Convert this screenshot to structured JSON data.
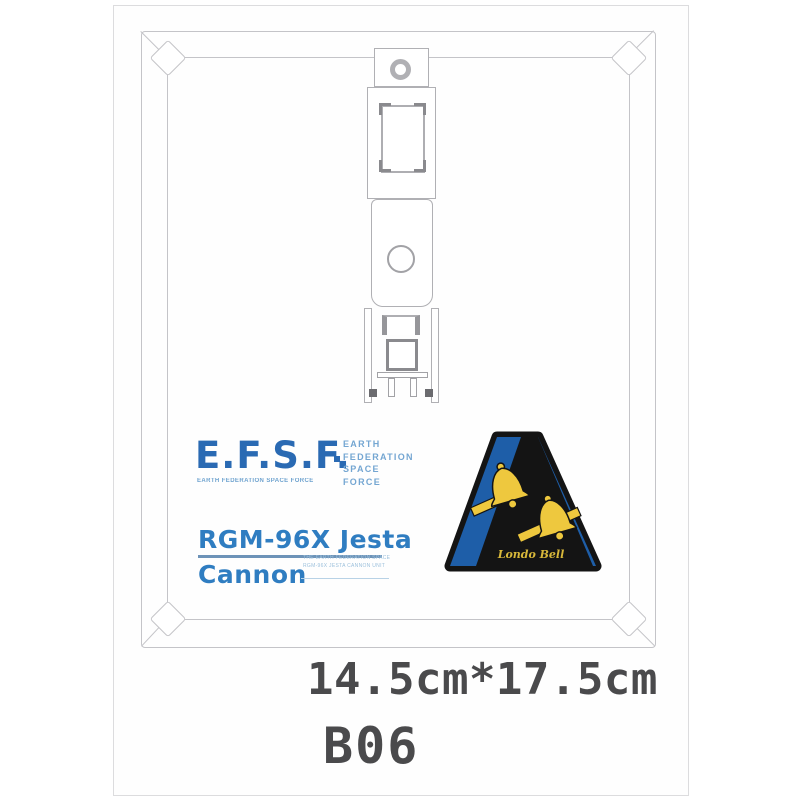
{
  "photo": {
    "efsf": {
      "acronym": "E.F.S.F.",
      "subtitle": "EARTH FEDERATION SPACE FORCE",
      "name_lines": [
        "EARTH",
        "FEDERATION",
        "SPACE",
        "FORCE"
      ]
    },
    "model": {
      "line1": "RGM-96X Jesta",
      "line2": "Cannon",
      "fine_print_line1": "THE EARTH FEDERATION SPACE FORCE",
      "fine_print_line2": "RGM-96X JESTA CANNON UNIT"
    },
    "emblem": {
      "unit_name": "Londo Bell",
      "icon": "twin-bells-icon",
      "colors": {
        "blue": "#1e5ea8",
        "black": "#141414",
        "gold": "#eec83e"
      }
    },
    "labels": {
      "size": "14.5cm*17.5cm",
      "code": "B06"
    }
  },
  "colors": {
    "efsf_blue": "#2a6ab3",
    "model_blue": "#2f7dc1",
    "accent_light_blue": "#74a6d2",
    "label_gray": "#4a4a4c",
    "outline_gray": "#c4c4c8",
    "diecut_gray": "#b0b0b4"
  }
}
